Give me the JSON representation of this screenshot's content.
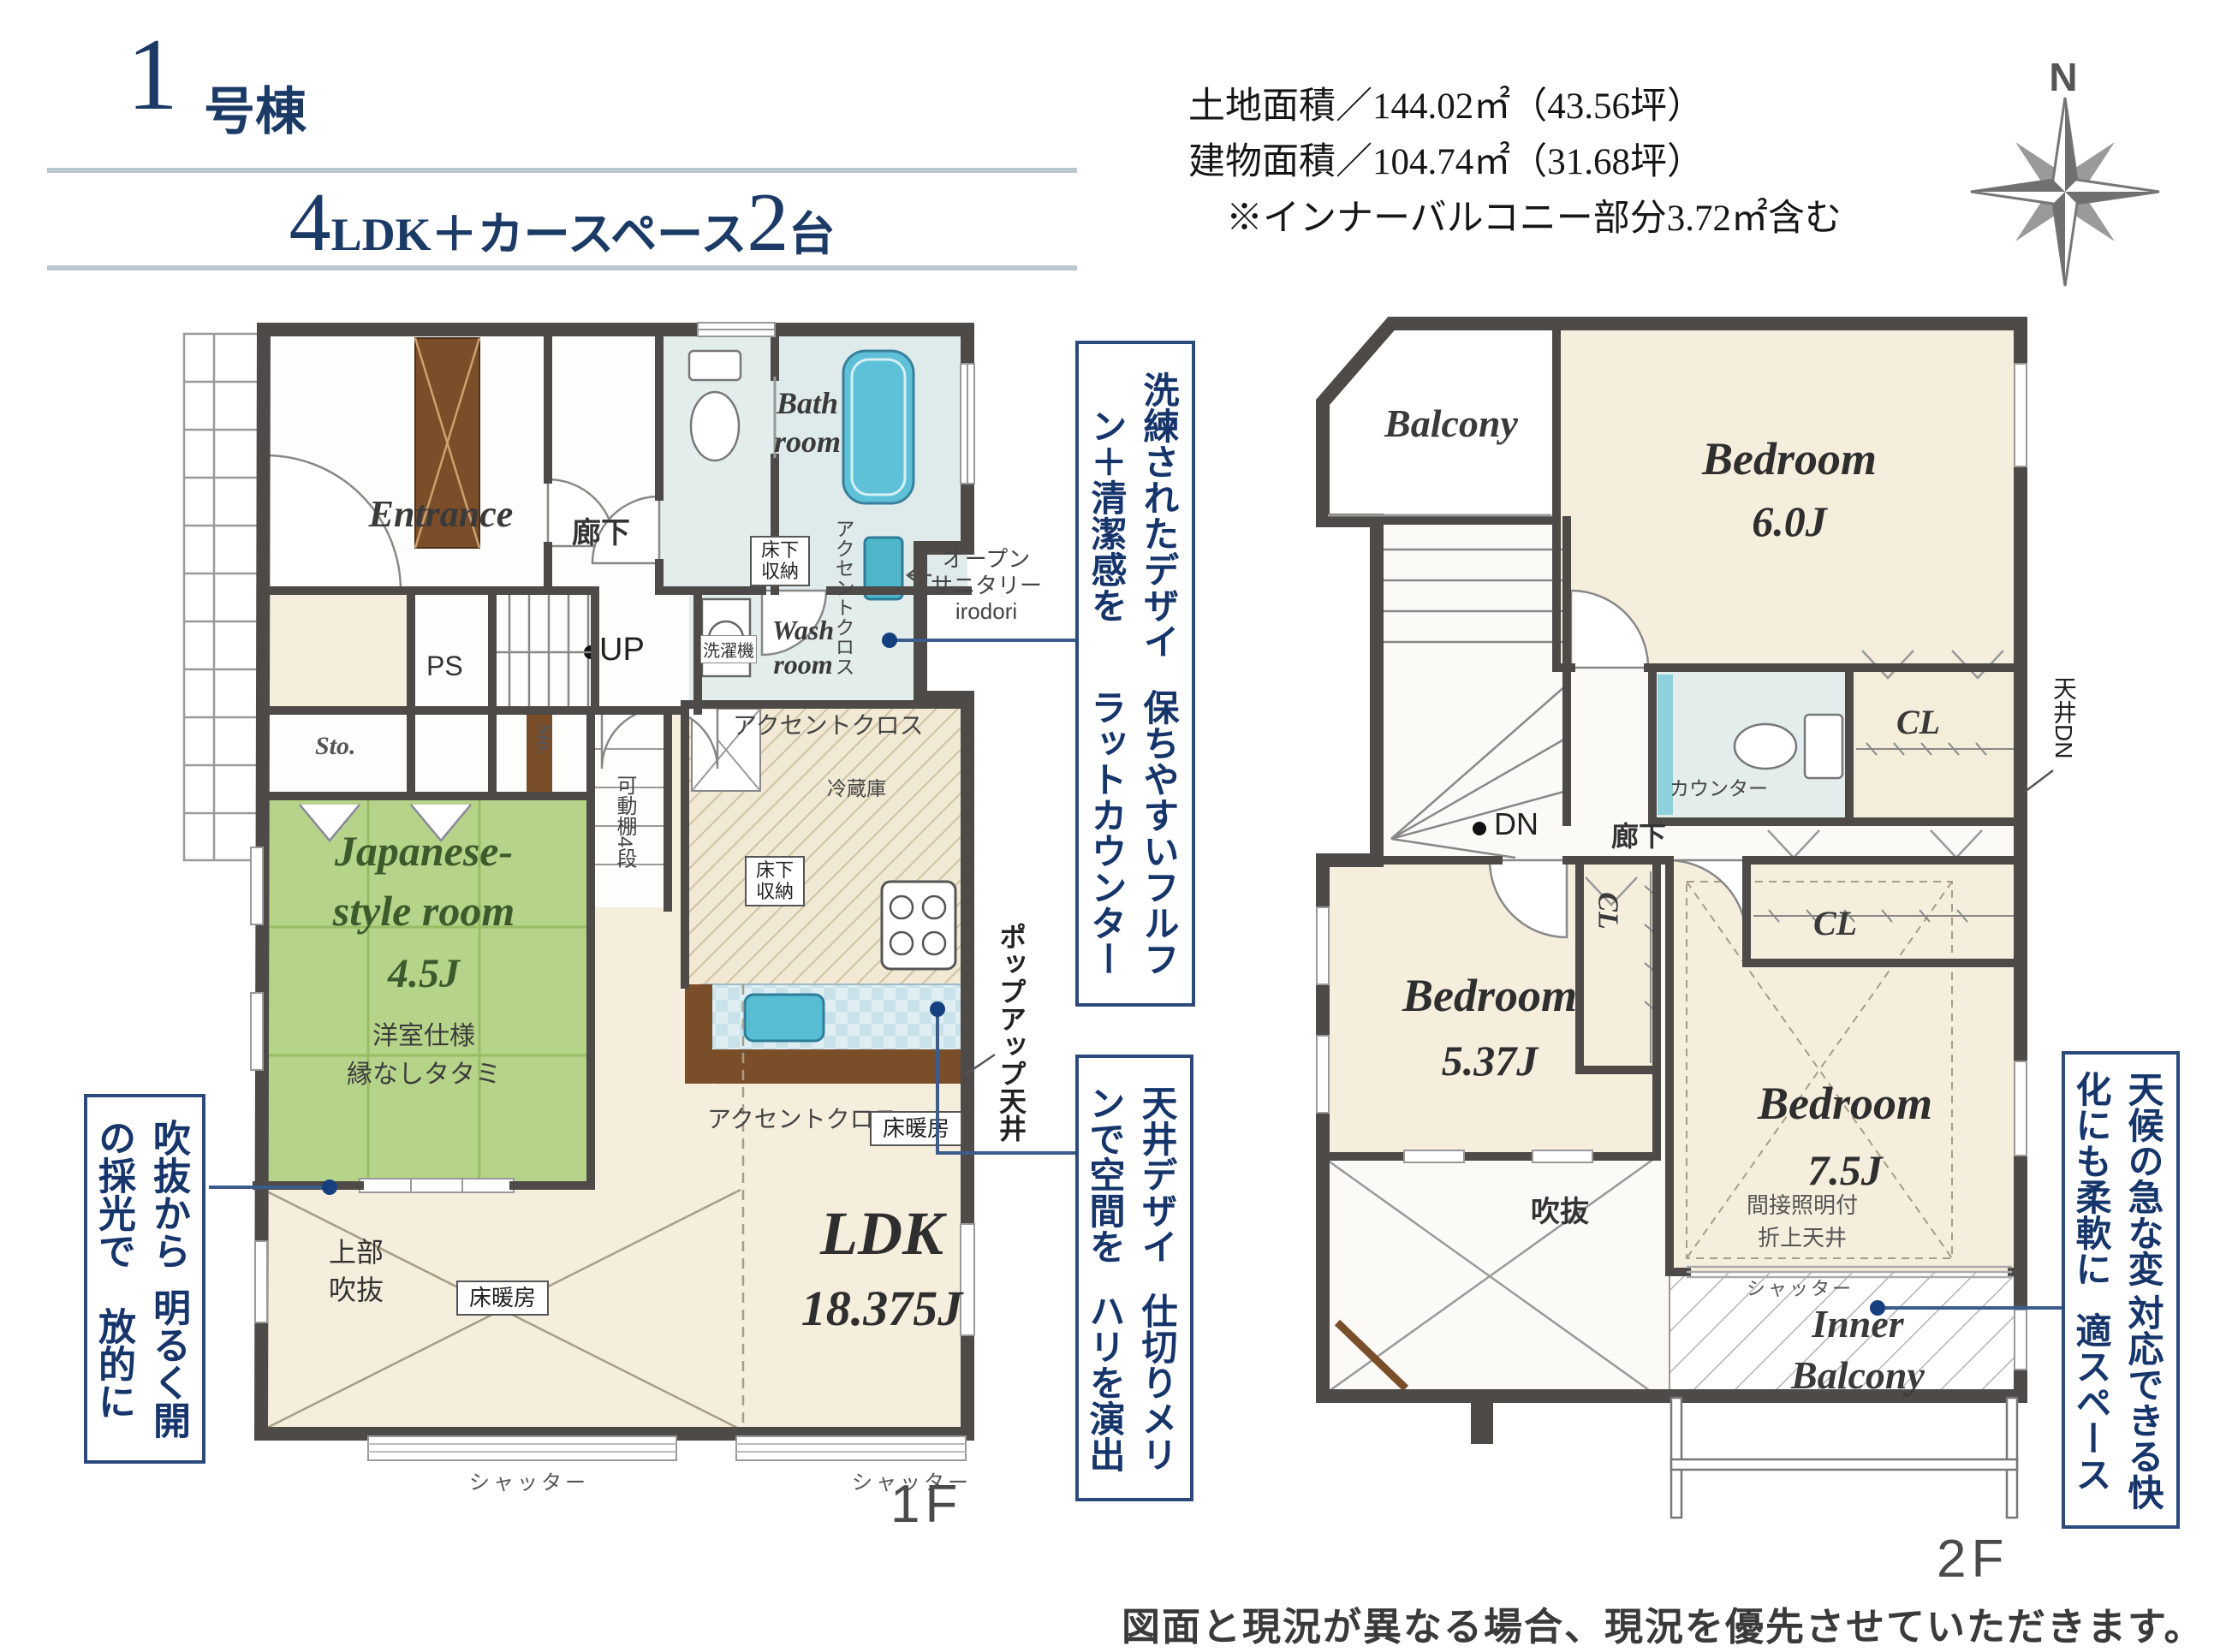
{
  "header": {
    "unit_number": "1",
    "unit_suffix": "号棟",
    "layout_num1": "4",
    "layout_mid": "LDK＋カースペース",
    "layout_num2": "2",
    "layout_tail": "台",
    "land_area_line": "土地面積／144.02㎡（43.56坪）",
    "building_area_line": "建物面積／104.74㎡（31.68坪）",
    "note_line": "※インナーバルコニー部分3.72㎡含む",
    "compass_n": "N"
  },
  "floor1": {
    "floor_label": "1F",
    "entrance": "Entrance",
    "corridor": "廊下",
    "bath_l1": "Bath",
    "bath_l2": "room",
    "wash_l1": "Wash",
    "wash_l2": "room",
    "washer": "洗濯機",
    "yukashita_l1": "床下",
    "yukashita_l2": "収納",
    "accent_cloth": "アクセントクロス",
    "open_sanitary_l1": "オープン",
    "open_sanitary_l2": "サニタリー",
    "open_sanitary_l3": "irodori",
    "ps": "PS",
    "up": "UP",
    "sto": "Sto.",
    "kadoudana": "可動棚4段",
    "reizouko": "冷蔵庫",
    "popup_ceiling": "ポップアップ天井",
    "jp_room_l1": "Japanese-",
    "jp_room_l2": "style room",
    "jp_room_size": "4.5J",
    "jp_room_spec1": "洋室仕様",
    "jp_room_spec2": "縁なしタタミ",
    "ldk": "LDK",
    "ldk_size": "18.375J",
    "yukadanbou": "床暖房",
    "void_l1": "上部",
    "void_l2": "吹抜",
    "shutter": "シャッター"
  },
  "floor2": {
    "floor_label": "2F",
    "balcony": "Balcony",
    "bedroom": "Bedroom",
    "bed1_size": "6.0J",
    "bed2_size": "5.37J",
    "bed3_size": "7.5J",
    "counter": "カウンター",
    "cl": "CL",
    "tenjou_dn": "天井DN",
    "dn": "DN",
    "corridor": "廊下",
    "oriage_l1": "間接照明付",
    "oriage_l2": "折上天井",
    "void": "吹抜",
    "shutter": "シャッター",
    "inner_l1": "Inner",
    "inner_l2": "Balcony"
  },
  "annotations": {
    "a1_line1": "洗練されたデザイン＋清潔感を",
    "a1_line2": "保ちやすいフルフラットカウンター",
    "a2_line1": "吹抜からの採光で",
    "a2_line2": "明るく開放的に",
    "a3_line1": "天井デザインで空間を",
    "a3_line2": "仕切りメリハリを演出",
    "a4_line1": "天候の急な変化にも柔軟に",
    "a4_line2": "対応できる快適スペース"
  },
  "footer": {
    "disclaimer": "図面と現況が異なる場合、現況を優先させていただきます。"
  },
  "colors": {
    "accent_navy": "#1c3a66",
    "annotation_navy": "#2a4a7c",
    "wall": "#4d4a48",
    "floor_cream": "#f5eedd",
    "tatami_green": "#b6d38a",
    "wet_blue": "#e3edec",
    "tub_blue": "#5ec1d8",
    "counter_brown": "#7b4e2a",
    "rule_blue": "#b9c7ce"
  }
}
